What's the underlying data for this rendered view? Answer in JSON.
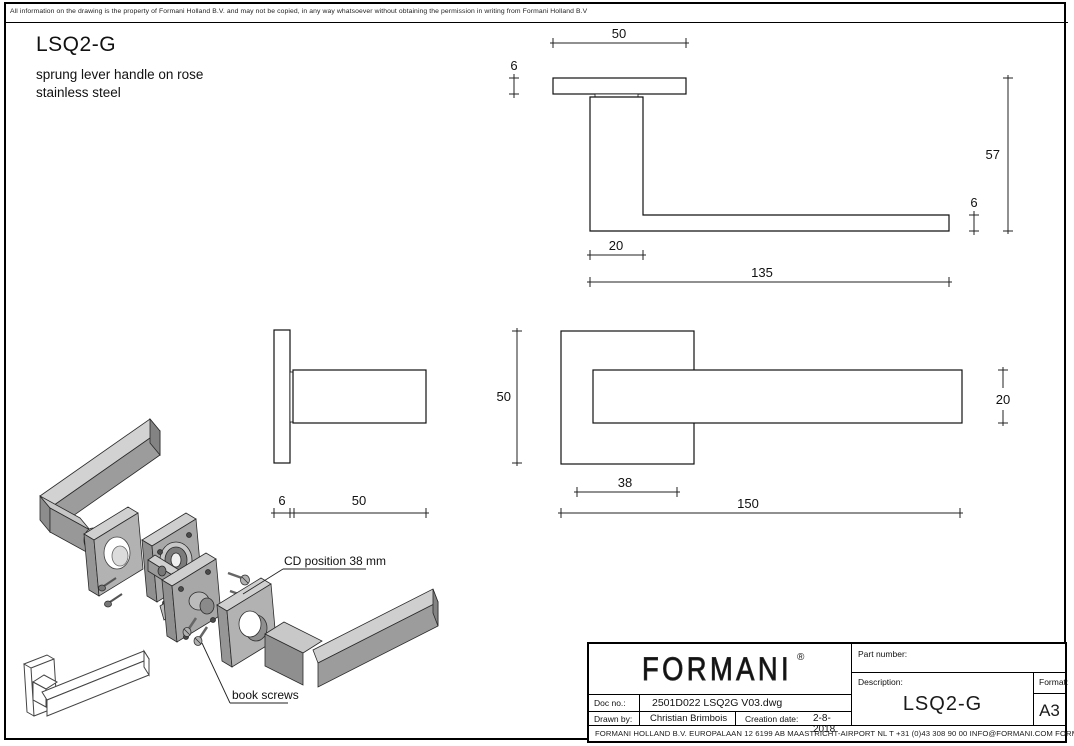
{
  "page": {
    "disclaimer": "All information on the drawing is the property of Formani Holland B.V. and may not be copied, in any way whatsoever without obtaining the permission in writing from Formani Holland B.V",
    "title": "LSQ2-G",
    "subtitle1": "sprung lever handle on rose",
    "subtitle2": "stainless steel"
  },
  "dims": {
    "side_rose_width": "50",
    "side_rose_thickness": "6",
    "side_total_height": "57",
    "side_lever_thickness": "6",
    "side_neck_depth": "20",
    "side_lever_length": "135",
    "profile_rose_thickness": "6",
    "profile_neck_length": "50",
    "front_rose_height": "50",
    "front_lever_height": "20",
    "front_cd": "38",
    "front_total_length": "150"
  },
  "exploded": {
    "cd_label": "CD position 38 mm",
    "screws_label": "book screws"
  },
  "title_block": {
    "logo": "FORMANI",
    "registered": "®",
    "part_number_label": "Part number:",
    "description_label": "Description:",
    "description": "LSQ2-G",
    "format_label": "Format:",
    "format": "A3",
    "doc_no_label": "Doc no.:",
    "doc_no": "2501D022 LSQ2G V03.dwg",
    "drawn_by_label": "Drawn by:",
    "drawn_by": "Christian Brimbois",
    "creation_date_label": "Creation date:",
    "creation_date": "2-8-2018",
    "footer": "FORMANI HOLLAND B.V.  EUROPALAAN 12  6199 AB MAASTRICHT-AIRPORT NL  T +31 (0)43 308 90 00 INFO@FORMANI.COM FORMANI.COM"
  }
}
